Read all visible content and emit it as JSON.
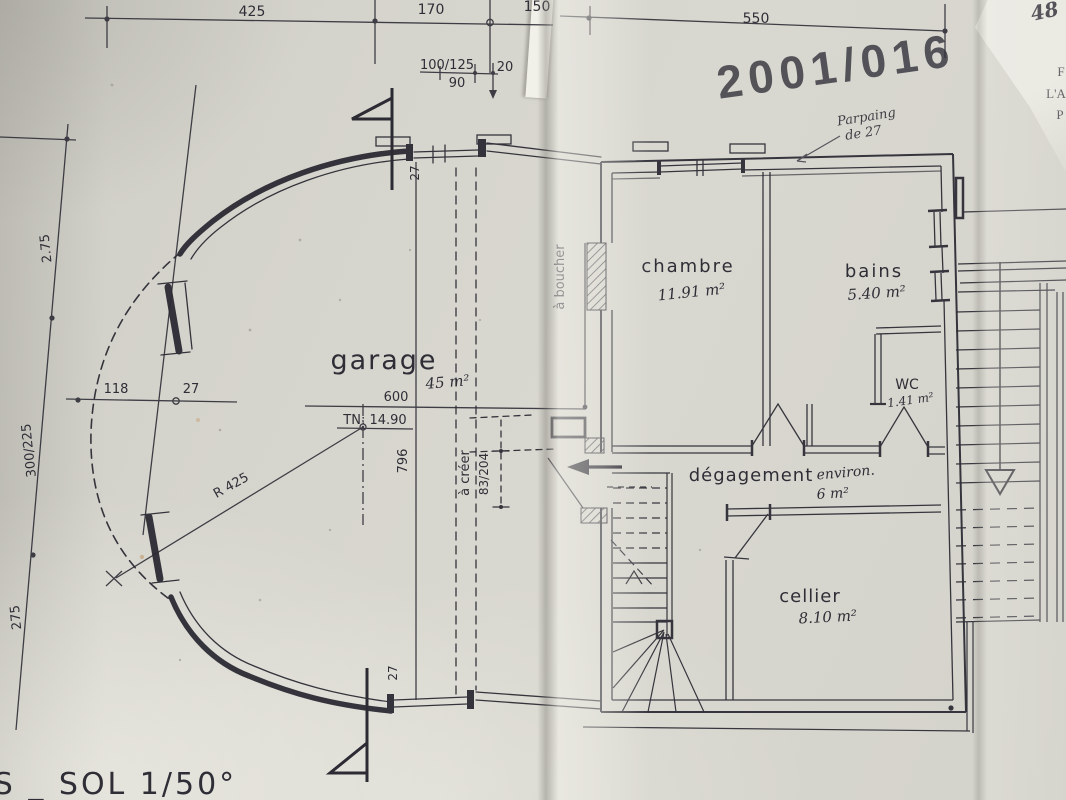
{
  "meta": {
    "kind": "scanned architectural floor plan photo",
    "sheet_title": "US _ SOL  1/50°",
    "scale": "1/50",
    "ink_color": "#32313a",
    "stamp_color": "#c45e7a"
  },
  "stamp": {
    "text": "2001/016"
  },
  "handwritten_notes": {
    "top_right_blue": "48",
    "wall_note_line1": "Parpaing",
    "wall_note_line2": "de 27",
    "blue_margin_fragments": [
      "F",
      "L'A",
      "P"
    ]
  },
  "rooms": [
    {
      "name": "garage",
      "area": "45 m²"
    },
    {
      "name": "chambre",
      "area": "11.91 m²"
    },
    {
      "name": "bains",
      "area": "5.40 m²"
    },
    {
      "name": "WC",
      "area": "1.41 m²"
    },
    {
      "name": "dégagement",
      "qualifier": "environ.",
      "area": "6 m²"
    },
    {
      "name": "cellier",
      "area": "8.10 m²"
    }
  ],
  "dimensions": {
    "top_chain": [
      "425",
      "170",
      "150",
      "550"
    ],
    "top_opening": {
      "size": "100/125",
      "width": "90",
      "offset": "20"
    },
    "left_chain": [
      "2.75",
      "300/225",
      "275"
    ],
    "garage": {
      "interior_width": "600",
      "interior_depth": "796",
      "front_offset": "118",
      "wall_thickness": "27",
      "curve_radius": "R 425",
      "ground_level": "TN: 14.90"
    },
    "door_to_create": {
      "note": "à créer",
      "size": "83/204"
    },
    "opening_to_block": "à boucher"
  },
  "labels": [
    {
      "id": "dim-top-425",
      "text": "425",
      "x": 252,
      "y": 16,
      "size": 14
    },
    {
      "id": "dim-top-170",
      "text": "170",
      "x": 431,
      "y": 14,
      "size": 14
    },
    {
      "id": "dim-top-150",
      "text": "150",
      "x": 537,
      "y": 11,
      "size": 14
    },
    {
      "id": "dim-top-550",
      "text": "550",
      "x": 756,
      "y": 23,
      "size": 14
    },
    {
      "id": "dim-open-100-125",
      "text": "100/125",
      "x": 447,
      "y": 69,
      "size": 13
    },
    {
      "id": "dim-open-20",
      "text": "20",
      "x": 505,
      "y": 71,
      "size": 13
    },
    {
      "id": "dim-open-90",
      "text": "90",
      "x": 457,
      "y": 87,
      "size": 13
    },
    {
      "id": "dim-left-2-75",
      "text": "2.75",
      "x": 50,
      "y": 248,
      "size": 13,
      "rot": -96
    },
    {
      "id": "dim-left-300-225",
      "text": "300/225",
      "x": 33,
      "y": 450,
      "size": 13,
      "rot": -96
    },
    {
      "id": "dim-left-275",
      "text": "275",
      "x": 20,
      "y": 617,
      "size": 13,
      "rot": -96
    },
    {
      "id": "dim-garage-118",
      "text": "118",
      "x": 116,
      "y": 393,
      "size": 13
    },
    {
      "id": "dim-garage-27",
      "text": "27",
      "x": 191,
      "y": 393,
      "size": 13
    },
    {
      "id": "room-garage",
      "text": "garage",
      "x": 384,
      "y": 369,
      "size": 27,
      "ls": 2,
      "cls": "print-lg"
    },
    {
      "id": "area-garage",
      "text": "45 m²",
      "x": 448,
      "y": 387,
      "size": 15,
      "rot": -5,
      "cls": "hand"
    },
    {
      "id": "dim-garage-600",
      "text": "600",
      "x": 396,
      "y": 401,
      "size": 13
    },
    {
      "id": "level-tn",
      "text": "TN: 14.90",
      "x": 375,
      "y": 424,
      "size": 13
    },
    {
      "id": "dim-garage-796",
      "text": "796",
      "x": 407,
      "y": 461,
      "size": 13,
      "rot": -90
    },
    {
      "id": "radius-r425",
      "text": "R 425",
      "x": 233,
      "y": 489,
      "size": 13,
      "rot": -29
    },
    {
      "id": "dim-wall27-top",
      "text": "27",
      "x": 419,
      "y": 173,
      "size": 12,
      "rot": -90
    },
    {
      "id": "dim-wall27-bot",
      "text": "27",
      "x": 397,
      "y": 673,
      "size": 12,
      "rot": -90
    },
    {
      "id": "note-a-creer",
      "text": "à créer",
      "x": 469,
      "y": 473,
      "size": 13,
      "rot": -90
    },
    {
      "id": "dim-83-204",
      "text": "83/204",
      "x": 488,
      "y": 474,
      "size": 12,
      "rot": -90
    },
    {
      "id": "note-a-boucher",
      "text": "à boucher",
      "x": 564,
      "y": 277,
      "size": 13,
      "rot": -90
    },
    {
      "id": "room-chambre",
      "text": "chambre",
      "x": 688,
      "y": 272,
      "size": 18,
      "ls": 2
    },
    {
      "id": "area-chambre",
      "text": "11.91 m²",
      "x": 692,
      "y": 297,
      "size": 15,
      "rot": -6,
      "cls": "hand"
    },
    {
      "id": "room-bains",
      "text": "bains",
      "x": 874,
      "y": 277,
      "size": 18,
      "ls": 2
    },
    {
      "id": "area-bains",
      "text": "5.40 m²",
      "x": 877,
      "y": 298,
      "size": 15,
      "rot": -4,
      "cls": "hand"
    },
    {
      "id": "room-wc",
      "text": "WC",
      "x": 907,
      "y": 389,
      "size": 14
    },
    {
      "id": "area-wc",
      "text": "1.41 m²",
      "x": 911,
      "y": 404,
      "size": 12,
      "rot": -8,
      "cls": "hand"
    },
    {
      "id": "room-degagement",
      "text": "dégagement",
      "x": 751,
      "y": 481,
      "size": 18,
      "ls": 1
    },
    {
      "id": "note-environ",
      "text": "environ.",
      "x": 846,
      "y": 477,
      "size": 14,
      "rot": -5,
      "cls": "hand"
    },
    {
      "id": "area-degagement",
      "text": "6 m²",
      "x": 833,
      "y": 498,
      "size": 14,
      "rot": -3,
      "cls": "hand"
    },
    {
      "id": "room-cellier",
      "text": "cellier",
      "x": 810,
      "y": 602,
      "size": 18,
      "ls": 1
    },
    {
      "id": "area-cellier",
      "text": "8.10 m²",
      "x": 828,
      "y": 622,
      "size": 15,
      "rot": -3,
      "cls": "hand"
    },
    {
      "id": "note-parpaing-1",
      "text": "Parpaing",
      "x": 867,
      "y": 121,
      "size": 13,
      "rot": -9,
      "cls": "hand-pencil"
    },
    {
      "id": "note-parpaing-2",
      "text": "de 27",
      "x": 864,
      "y": 137,
      "size": 13,
      "rot": -9,
      "cls": "hand-pencil"
    },
    {
      "id": "stamp-number",
      "text": "2001/016",
      "x": 838,
      "y": 82,
      "size": 46,
      "rot": -8,
      "ls": 6,
      "cls": "stamp"
    },
    {
      "id": "note-48-blue",
      "text": "48",
      "x": 1046,
      "y": 18,
      "size": 20,
      "rot": -12,
      "cls": "hand-blue"
    },
    {
      "id": "margin-frag-1",
      "text": "F",
      "x": 1061,
      "y": 76,
      "size": 13,
      "cls": "print-blue"
    },
    {
      "id": "margin-frag-2",
      "text": "L'A",
      "x": 1056,
      "y": 98,
      "size": 13,
      "cls": "print-blue"
    },
    {
      "id": "margin-frag-3",
      "text": "P",
      "x": 1060,
      "y": 119,
      "size": 13,
      "cls": "print-blue"
    },
    {
      "id": "sheet-title",
      "text": "US _ SOL  1/50°",
      "x": 103,
      "y": 794,
      "size": 30,
      "ls": 3,
      "cls": "print-lg"
    }
  ]
}
